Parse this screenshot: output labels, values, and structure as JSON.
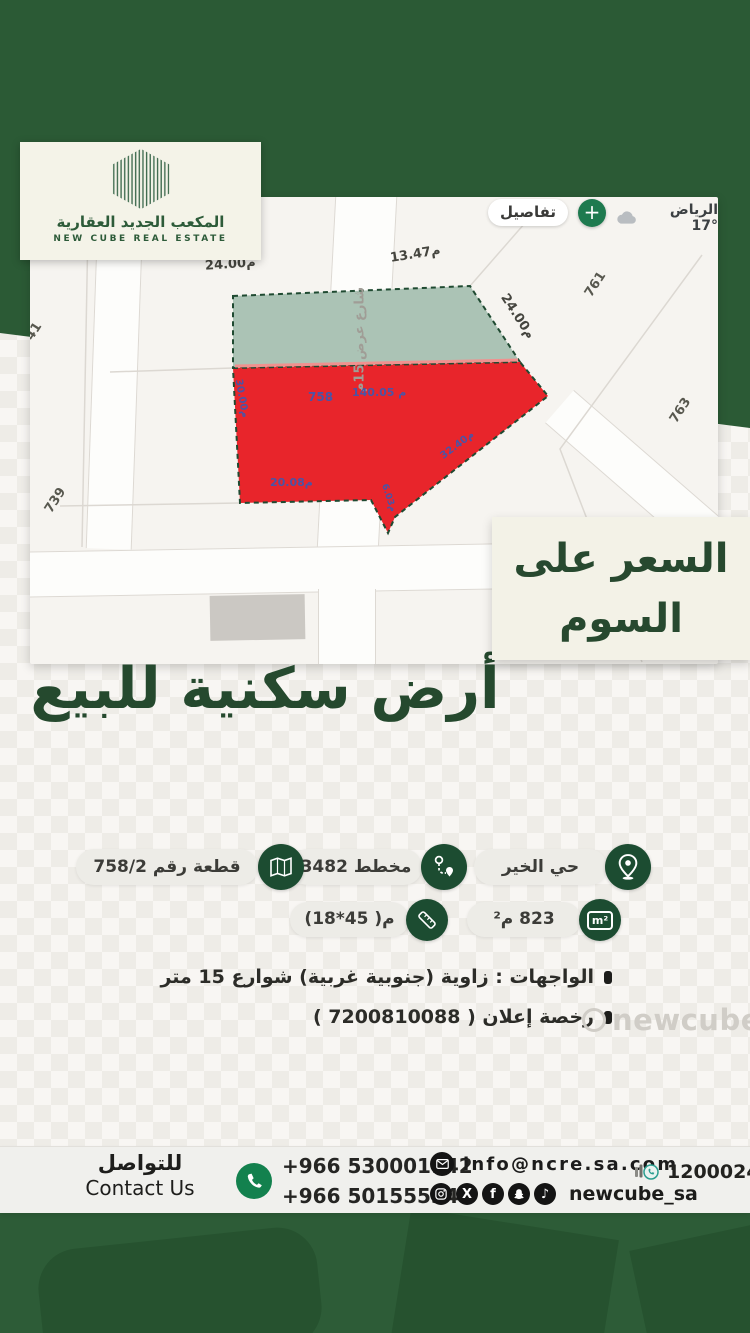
{
  "brand": {
    "name_ar": "المكعب الجديد العقارية",
    "name_en": "NEW CUBE REAL ESTATE"
  },
  "map": {
    "details_button": "تفاصيل",
    "plus_button": "+",
    "weather": "الرياض °17",
    "street_label": "شارع عرض 15م",
    "plot_number": "758",
    "measurements": {
      "top_left": "م24.00",
      "top_right": "م13.47",
      "right_side": "م24.00",
      "left_side": "م30.00",
      "inner_length": "م 140.05",
      "diagonal": "م32.40",
      "bottom": "م20.08",
      "notch": "م6.03"
    },
    "neighbor_plots": {
      "n1": "761",
      "n2": "763",
      "n3": "739",
      "n4": "41"
    }
  },
  "price_note": {
    "line1": "السعر على",
    "line2": "السوم"
  },
  "title": "أرض سكنية للبيع",
  "badges": {
    "district": {
      "label": "حي الخير"
    },
    "plan": {
      "label": "مخطط 3482"
    },
    "plot": {
      "label": "قطعة رقم 758/2"
    },
    "area": {
      "label": "823 م²",
      "icon_text": "m²"
    },
    "dimensions": {
      "label": "م( 45*18)"
    }
  },
  "details": {
    "frontage": "الواجهات : زاوية (جنوبية غربية) شوارع 15 متر",
    "license": "رخصة إعلان ( 7200810088 )"
  },
  "watermark": "newcube_sa",
  "contact": {
    "label_ar": "للتواصل",
    "label_en": "Contact Us",
    "phone1": "+966 530001142",
    "phone2": "+966 501555340",
    "email": "info@ncre.sa.com",
    "social_handle": "newcube_sa",
    "unified_number": "1200024175"
  }
}
